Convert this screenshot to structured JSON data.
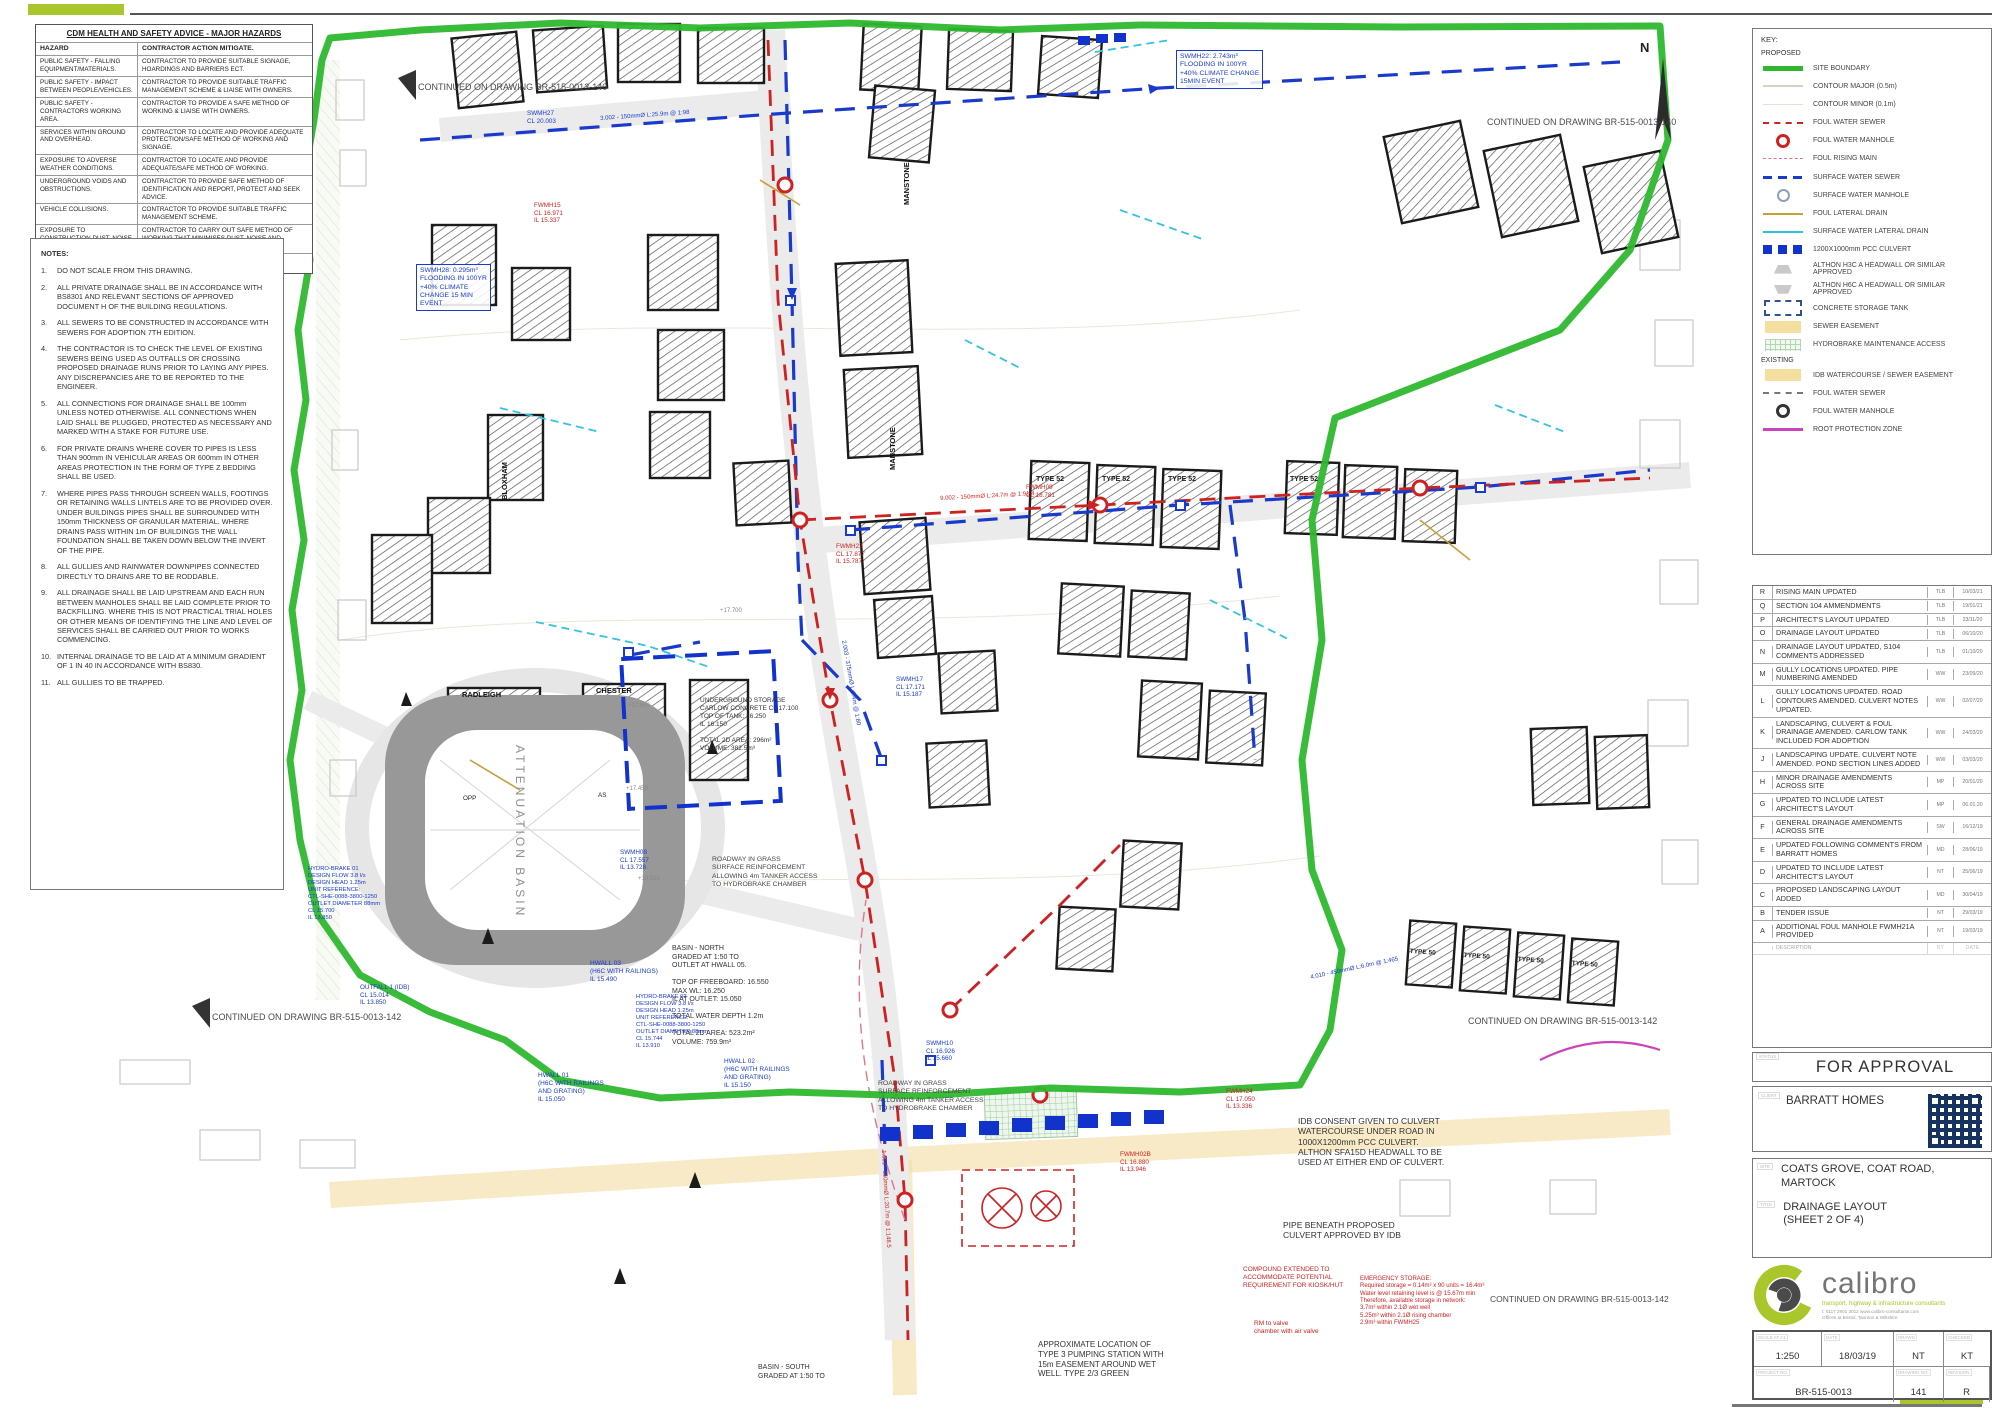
{
  "hazards": {
    "title": "CDM HEALTH AND SAFETY ADVICE - MAJOR HAZARDS",
    "col_hazard": "HAZARD",
    "col_action": "CONTRACTOR ACTION MITIGATE.",
    "rows": [
      {
        "hazard": "PUBLIC SAFETY - FALLING EQUIPMENT/MATERIALS.",
        "action": "CONTRACTOR TO PROVIDE SUITABLE SIGNAGE, HOARDINGS AND BARRIERS ECT."
      },
      {
        "hazard": "PUBLIC SAFETY - IMPACT BETWEEN PEOPLE/VEHICLES.",
        "action": "CONTRACTOR TO PROVIDE SUITABLE TRAFFIC MANAGEMENT SCHEME & LIAISE WITH OWNERS."
      },
      {
        "hazard": "PUBLIC SAFETY - CONTRACTORS WORKING AREA.",
        "action": "CONTRACTOR TO PROVIDE A SAFE METHOD OF WORKING & LIAISE WITH OWNERS."
      },
      {
        "hazard": "SERVICES WITHIN GROUND AND OVERHEAD.",
        "action": "CONTRACTOR TO LOCATE AND PROVIDE ADEQUATE PROTECTION/SAFE METHOD OF WORKING AND SIGNAGE."
      },
      {
        "hazard": "EXPOSURE TO ADVERSE WEATHER CONDITIONS.",
        "action": "CONTRACTOR TO LOCATE AND PROVIDE ADEQUATE/SAFE METHOD OF WORKING."
      },
      {
        "hazard": "UNDERGROUND VOIDS AND OBSTRUCTIONS.",
        "action": "CONTRACTOR TO PROVIDE SAFE METHOD OF IDENTIFICATION AND REPORT, PROTECT AND SEEK ADVICE."
      },
      {
        "hazard": "VEHICLE COLLISIONS.",
        "action": "CONTRACTOR TO PROVIDE SUITABLE TRAFFIC MANAGEMENT SCHEME."
      },
      {
        "hazard": "EXPOSURE TO CONSTRUCTION DUST, NOISE AND VIBRATION.",
        "action": "CONTRACTOR TO CARRY OUT SAFE METHOD OF WORKING THAT MINIMISES DUST, NOISE AND VIBRATION."
      }
    ],
    "footer": "THE HAZARDS IDENTIFIED ABOVE SHOULD NOT BE ASSUMED TO BE THE ONLY HAZARDS THAT COULD BE PRESENT ON THIS SITE."
  },
  "notes": {
    "title": "NOTES:",
    "items": [
      {
        "num": "1.",
        "text": "DO NOT SCALE FROM THIS DRAWING."
      },
      {
        "num": "2.",
        "text": "ALL PRIVATE DRAINAGE SHALL BE IN ACCORDANCE WITH BS8301 AND RELEVANT SECTIONS OF APPROVED DOCUMENT H OF THE BUILDING REGULATIONS."
      },
      {
        "num": "3.",
        "text": "ALL SEWERS TO BE CONSTRUCTED IN ACCORDANCE WITH SEWERS FOR ADOPTION 7TH EDITION."
      },
      {
        "num": "4.",
        "text": "THE CONTRACTOR IS TO CHECK THE LEVEL OF EXISTING SEWERS BEING USED AS OUTFALLS OR CROSSING PROPOSED DRAINAGE RUNS PRIOR TO LAYING ANY PIPES. ANY DISCREPANCIES ARE TO BE REPORTED TO THE ENGINEER."
      },
      {
        "num": "5.",
        "text": "ALL CONNECTIONS FOR DRAINAGE SHALL BE 100mm UNLESS NOTED OTHERWISE. ALL CONNECTIONS WHEN LAID SHALL BE PLUGGED, PROTECTED AS NECESSARY AND MARKED WITH A STAKE FOR FUTURE USE."
      },
      {
        "num": "6.",
        "text": "FOR PRIVATE DRAINS WHERE COVER TO PIPES IS LESS THAN 900mm IN VEHICULAR AREAS OR 600mm IN OTHER AREAS PROTECTION IN THE FORM OF TYPE Z BEDDING SHALL BE USED."
      },
      {
        "num": "7.",
        "text": "WHERE PIPES PASS THROUGH SCREEN WALLS, FOOTINGS OR RETAINING WALLS LINTELS ARE TO BE PROVIDED OVER. UNDER BUILDINGS PIPES SHALL BE SURROUNDED WITH 150mm THICKNESS OF GRANULAR MATERIAL. WHERE DRAINS PASS WITHIN 1m OF BUILDINGS THE WALL FOUNDATION SHALL BE TAKEN DOWN BELOW THE INVERT OF THE PIPE."
      },
      {
        "num": "8.",
        "text": "ALL GULLIES AND RAINWATER DOWNPIPES CONNECTED DIRECTLY TO DRAINS ARE TO BE RODDABLE."
      },
      {
        "num": "9.",
        "text": "ALL DRAINAGE SHALL BE LAID UPSTREAM AND EACH RUN BETWEEN MANHOLES SHALL BE LAID COMPLETE PRIOR TO BACKFILLING. WHERE THIS IS NOT PRACTICAL TRIAL HOLES OR OTHER MEANS OF IDENTIFYING THE LINE AND LEVEL OF SERVICES SHALL BE CARRIED OUT PRIOR TO WORKS COMMENCING."
      },
      {
        "num": "10.",
        "text": "INTERNAL DRAINAGE TO BE LAID AT A MINIMUM GRADIENT OF 1 IN 40 IN ACCORDANCE WITH BS830."
      },
      {
        "num": "11.",
        "text": "ALL GULLIES TO BE TRAPPED."
      }
    ]
  },
  "key": {
    "title": "KEY:",
    "proposed_label": "PROPOSED",
    "existing_label": "EXISTING",
    "proposed": [
      {
        "label": "SITE BOUNDARY",
        "swatch": "sw-boundary"
      },
      {
        "label": "CONTOUR MAJOR (0.5m)",
        "swatch": "sw-contour-major"
      },
      {
        "label": "CONTOUR MINOR (0.1m)",
        "swatch": "sw-contour-minor"
      },
      {
        "label": "FOUL WATER SEWER",
        "swatch": "sw-foul"
      },
      {
        "label": "FOUL WATER MANHOLE",
        "swatch": "sw-foul-mh"
      },
      {
        "label": "FOUL RISING MAIN",
        "swatch": "sw-rising"
      },
      {
        "label": "SURFACE WATER SEWER",
        "swatch": "sw-sw"
      },
      {
        "label": "SURFACE WATER MANHOLE",
        "swatch": "sw-sw-mh"
      },
      {
        "label": "FOUL LATERAL DRAIN",
        "swatch": "sw-foul-lat"
      },
      {
        "label": "SURFACE WATER LATERAL DRAIN",
        "swatch": "sw-sw-lat"
      },
      {
        "label": "1200X1000mm PCC CULVERT",
        "swatch": "sw-culvert"
      },
      {
        "label": "ALTHON H3C A HEADWALL OR SIMILAR APPROVED",
        "swatch": "sw-headwall-a"
      },
      {
        "label": "ALTHON H6C A HEADWALL OR SIMILAR APPROVED",
        "swatch": "sw-headwall-b"
      },
      {
        "label": "CONCRETE STORAGE TANK",
        "swatch": "sw-tank"
      },
      {
        "label": "SEWER EASEMENT",
        "swatch": "sw-easement"
      },
      {
        "label": "HYDROBRAKE MAINTENANCE ACCESS",
        "swatch": "sw-hydro"
      }
    ],
    "existing": [
      {
        "label": "IDB WATERCOURSE / SEWER EASEMENT",
        "swatch": "sw-easement"
      },
      {
        "label": "FOUL WATER SEWER",
        "swatch": "sw-ex-foul"
      },
      {
        "label": "FOUL WATER MANHOLE",
        "swatch": "sw-ex-foul-mh"
      },
      {
        "label": "ROOT PROTECTION ZONE",
        "swatch": "sw-root"
      }
    ]
  },
  "revisions": {
    "rows": [
      {
        "rev": "R",
        "desc": "RISING MAIN UPDATED",
        "by": "TLB",
        "date": "10/03/21"
      },
      {
        "rev": "Q",
        "desc": "SECTION 104 AMMENDMENTS",
        "by": "TLB",
        "date": "19/01/21"
      },
      {
        "rev": "P",
        "desc": "ARCHITECT'S LAYOUT UPDATED",
        "by": "TLB",
        "date": "23/11/20"
      },
      {
        "rev": "O",
        "desc": "DRAINAGE LAYOUT UPDATED",
        "by": "TLB",
        "date": "06/10/20"
      },
      {
        "rev": "N",
        "desc": "DRAINAGE LAYOUT UPDATED, S104 COMMENTS ADDRESSED",
        "by": "TLB",
        "date": "01/10/20"
      },
      {
        "rev": "M",
        "desc": "GULLY LOCATIONS UPDATED. PIPE NUMBERING AMENDED",
        "by": "WW",
        "date": "23/09/20"
      },
      {
        "rev": "L",
        "desc": "GULLY LOCATIONS UPDATED. ROAD CONTOURS AMENDED. CULVERT NOTES UPDATED.",
        "by": "WW",
        "date": "02/07/20"
      },
      {
        "rev": "K",
        "desc": "LANDSCAPING, CULVERT & FOUL DRAINAGE AMENDED. CARLOW TANK INCLUDED FOR ADOPTION",
        "by": "WW",
        "date": "24/03/20"
      },
      {
        "rev": "J",
        "desc": "LANDSCAPING UPDATE. CULVERT NOTE AMENDED. POND SECTION LINES ADDED",
        "by": "WW",
        "date": "03/03/20"
      },
      {
        "rev": "H",
        "desc": "MINOR DRAINAGE AMENDMENTS ACROSS SITE",
        "by": "MP",
        "date": "20/01/20"
      },
      {
        "rev": "G",
        "desc": "UPDATED TO INCLUDE LATEST ARCHITECT'S LAYOUT",
        "by": "MP",
        "date": "06.01.20"
      },
      {
        "rev": "F",
        "desc": "GENERAL DRAINAGE AMENDMENTS ACROSS SITE",
        "by": "SW",
        "date": "16/12/19"
      },
      {
        "rev": "E",
        "desc": "UPDATED FOLLOWING COMMENTS FROM BARRATT HOMES",
        "by": "MD",
        "date": "28/06/19"
      },
      {
        "rev": "D",
        "desc": "UPDATED TO INCLUDE LATEST ARCHITECT'S LAYOUT",
        "by": "NT",
        "date": "25/06/19"
      },
      {
        "rev": "C",
        "desc": "PROPOSED LANDSCAPING LAYOUT ADDED",
        "by": "MD",
        "date": "30/04/19"
      },
      {
        "rev": "B",
        "desc": "TENDER ISSUE",
        "by": "NT",
        "date": "29/03/19"
      },
      {
        "rev": "A",
        "desc": "ADDITIONAL FOUL MANHOLE FWMH21A PROVIDED",
        "by": "NT",
        "date": "19/03/19"
      }
    ],
    "head": {
      "rev": "",
      "desc": "DESCRIPTION",
      "by": "BY",
      "date": "DATE"
    }
  },
  "titleblock": {
    "status_label": "STATUS",
    "status": "FOR APPROVAL",
    "client_label": "CLIENT",
    "client": "BARRATT HOMES",
    "site_label": "SITE",
    "site": "COATS GROVE, COAT ROAD,\nMARTOCK",
    "title_label": "TITLE",
    "drawing_title": "DRAINAGE LAYOUT\n(SHEET 2 OF 4)",
    "logo_word": "calibro",
    "logo_tagline": "transport, highway & infrastructure consultants",
    "logo_contact": "t: 0117 2901 3012        www.calibro-consultants.com\nOffices at Bristol, Taunton & Wiltshire",
    "scale_label": "SCALE AT A1",
    "scale": "1:250",
    "date_label": "DATE",
    "date": "18/03/19",
    "drawn_label": "DRAWN",
    "drawn": "NT",
    "checked_label": "CHECKED",
    "checked": "KT",
    "project_no_label": "PROJECT NO.",
    "project_no": "BR-515-0013",
    "drawing_no_label": "DRAWING NO.",
    "drawing_no": "141",
    "revision_label": "REVISION",
    "revision": "R"
  },
  "plan": {
    "north": "N",
    "annotations": [
      {
        "text": "CONTINUED ON DRAWING BR-515-0013-140",
        "x": 418,
        "y": 82,
        "color": "#4a4a4a",
        "size": 9
      },
      {
        "text": "CONTINUED ON DRAWING BR-515-0013-140",
        "x": 1487,
        "y": 117,
        "color": "#4a4a4a",
        "size": 9
      },
      {
        "text": "CONTINUED ON DRAWING BR-515-0013-142",
        "x": 212,
        "y": 1012,
        "color": "#4a4a4a",
        "size": 9
      },
      {
        "text": "CONTINUED ON DRAWING BR-515-0013-142",
        "x": 1468,
        "y": 1016,
        "color": "#4a4a4a",
        "size": 9
      },
      {
        "text": "CONTINUED ON DRAWING BR-515-0013-142",
        "x": 1490,
        "y": 1294,
        "color": "#4a4a4a",
        "size": 8.5
      },
      {
        "text": "TIMBER KNEE RAIL FENCING AROUND TOP\nOF ATTENUATION BASIN - REFER TO\nARCHITECT'S PLANS FOR DETAILS",
        "x": 80,
        "y": 782,
        "color": "#555555",
        "size": 7.5,
        "w": 175
      },
      {
        "text": "BASIN - NORTH\nGRADED AT 1:50 TO\nOUTLET AT HWALL 05.\n\nTOP OF FREEBOARD: 16.550\nMAX WL: 16.250\nIL AT OUTLET: 15.050\n\nTOTAL WATER DEPTH 1.2m\n\nTOTAL 2D AREA: 523.2m²\nVOLUME: 759.9m³",
        "x": 672,
        "y": 945,
        "color": "#333333",
        "size": 7,
        "w": 130
      },
      {
        "text": "HWALL 03\n(H6C WITH RAILINGS)\nIL 15.490",
        "x": 590,
        "y": 960,
        "color": "#1a3acc",
        "size": 6.5
      },
      {
        "text": "HWALL 01\n(H6C WITH RAILINGS\nAND GRATING)\nIL 15.050",
        "x": 538,
        "y": 1072,
        "color": "#1a3acc",
        "size": 6.5
      },
      {
        "text": "HWALL 02\n(H6C WITH RAILINGS\nAND GRATING)\nIL 15.150",
        "x": 724,
        "y": 1058,
        "color": "#1a3acc",
        "size": 6.5
      },
      {
        "text": "IDB CONSENT GIVEN TO  CULVERT\nWATERCOURSE UNDER ROAD IN\n1000X1200mm PCC CULVERT.\nALTHON SFA15D HEADWALL TO BE\nUSED AT EITHER END OF CULVERT.",
        "x": 1298,
        "y": 1116,
        "color": "#333333",
        "size": 8.5
      },
      {
        "text": "PIPE BENEATH PROPOSED\nCULVERT APPROVED BY IDB",
        "x": 1283,
        "y": 1220,
        "color": "#333333",
        "size": 8.5
      },
      {
        "text": "APPROXIMATE  LOCATION OF\nTYPE 3 PUMPING STATION WITH\n15m EASEMENT AROUND WET\nWELL. TYPE 2/3 GREEN",
        "x": 1038,
        "y": 1340,
        "color": "#333333",
        "size": 8
      },
      {
        "text": "EMERGENCY STORAGE:\nRequired storage = 0.14m³ x 90 units = 16.4m³\nWater level retaining level is @ 15.67m min\nTherefore, available storage in network:\n3.7m³ within 2.1Ø wet well\n5.25m³ within 2.1Ø rising chamber\n2.9m³ within FWMH25",
        "x": 1360,
        "y": 1276,
        "color": "#cc2222",
        "size": 6,
        "w": 165
      },
      {
        "text": "COMPOUND EXTENDED TO\nACCOMMODATE POTENTIAL\nREQUIREMENT FOR KIOSK/HUT",
        "x": 1243,
        "y": 1266,
        "color": "#cc2222",
        "size": 6.5
      },
      {
        "text": "RM to valve\nchamber with air valve",
        "x": 1254,
        "y": 1320,
        "color": "#cc2222",
        "size": 6.5
      },
      {
        "text": "ROADWAY IN GRASS\nSURFACE REINFORCEMENT\nALLOWING 4m TANKER ACCESS\nTO HYDROBRAKE CHAMBER",
        "x": 712,
        "y": 856,
        "color": "#444444",
        "size": 6.8
      },
      {
        "text": "ROADWAY IN GRASS\nSURFACE REINFORCEMENT\nALLOWING 4m TANKER ACCESS\nTO HYDROBRAKE CHAMBER",
        "x": 878,
        "y": 1080,
        "color": "#444444",
        "size": 6.8
      },
      {
        "text": "UNDERGROUND STORAGE\nCARLOW CONCRETE CL 17.100\nTOP OF TANK: 16.250\nIL 16.150\n\nTOTAL 2D AREA: 296m²\nVOLUME: 382.5m³",
        "x": 700,
        "y": 697,
        "color": "#333333",
        "size": 6.5,
        "w": 110
      },
      {
        "text": "SWMH28: 0.295m³\nFLOODING IN 100YR\n+40% CLIMATE\nCHANGE 15 MIN\nEVENT",
        "x": 416,
        "y": 264,
        "color": "#1a3acc",
        "size": 6.8,
        "box": true
      },
      {
        "text": "SWMH22: 2.743m³\nFLOODING IN 100YR\n+40% CLIMATE CHANGE\n15MIN EVENT",
        "x": 1176,
        "y": 50,
        "color": "#1a3acc",
        "size": 6.8,
        "box": true
      },
      {
        "text": "SWMH27\nCL 20.003",
        "x": 527,
        "y": 110,
        "color": "#1a3acc",
        "size": 6.3
      },
      {
        "text": "FWMH15\nCL 16.971\nIL 15.337",
        "x": 534,
        "y": 202,
        "color": "#cc2222",
        "size": 6.3
      },
      {
        "text": "SWMH08\nCL 17.557\nIL 13.728",
        "x": 620,
        "y": 849,
        "color": "#1a3acc",
        "size": 6.3
      },
      {
        "text": "OUTFALL 1 (IDB)\nCL 15.014\nIL 13.850",
        "x": 360,
        "y": 984,
        "color": "#1a3acc",
        "size": 6.3
      },
      {
        "text": "HYDRO-BRAKE 01\nDESIGN FLOW 3.8 l/s\nDESIGN HEAD 1.25m\nUNIT REFERENCE:\nCTL-SHE-0088-3800-1250\nOUTLET DIAMETER 88mm\nCL 15.700\nIL 13.850",
        "x": 308,
        "y": 866,
        "color": "#1a3acc",
        "size": 5.8
      },
      {
        "text": "HYDRO-BRAKE 02\nDESIGN FLOW 3.8 l/s\nDESIGN HEAD 1.25m\nUNIT REFERENCE:\nCTL-SHE-0088-3800-1250\nOUTLET DIAMETER 88mm\nCL 15.744\nIL 13.910",
        "x": 636,
        "y": 994,
        "color": "#1a3acc",
        "size": 5.8
      },
      {
        "text": "BASIN - SOUTH\nGRADED AT 1:50 TO",
        "x": 758,
        "y": 1364,
        "color": "#333333",
        "size": 7
      },
      {
        "text": "SWMH10\nCL 16.926\nIL 15.660",
        "x": 926,
        "y": 1040,
        "color": "#1a3acc",
        "size": 6.3
      },
      {
        "text": "FWMH02B\nCL 16.880\nIL 13.946",
        "x": 1120,
        "y": 1151,
        "color": "#cc2222",
        "size": 6.3
      },
      {
        "text": "FWMH24\nCL 17.050\nIL 13.336",
        "x": 1226,
        "y": 1088,
        "color": "#cc2222",
        "size": 6.3
      },
      {
        "text": "FWMH09\nCL 18.781",
        "x": 1026,
        "y": 484,
        "color": "#cc2222",
        "size": 6.3
      },
      {
        "text": "SWMH17\nCL 17.171\nIL 15.187",
        "x": 896,
        "y": 676,
        "color": "#1a3acc",
        "size": 6.3
      },
      {
        "text": "FWMH22\nCL 17.877\nIL 15.787",
        "x": 836,
        "y": 543,
        "color": "#cc2222",
        "size": 6.3
      },
      {
        "text": "TYPE 52",
        "x": 1036,
        "y": 476,
        "color": "#1b1b1b",
        "size": 7,
        "bold": true
      },
      {
        "text": "TYPE 52",
        "x": 1102,
        "y": 476,
        "color": "#1b1b1b",
        "size": 7,
        "bold": true
      },
      {
        "text": "TYPE 52",
        "x": 1168,
        "y": 476,
        "color": "#1b1b1b",
        "size": 7,
        "bold": true
      },
      {
        "text": "TYPE 52",
        "x": 1290,
        "y": 476,
        "color": "#1b1b1b",
        "size": 7,
        "bold": true
      },
      {
        "text": "TYPE 50",
        "x": 1410,
        "y": 948,
        "color": "#1b1b1b",
        "size": 6.5,
        "bold": true,
        "rot": 4
      },
      {
        "text": "TYPE 50",
        "x": 1464,
        "y": 952,
        "color": "#1b1b1b",
        "size": 6.5,
        "bold": true,
        "rot": 4
      },
      {
        "text": "TYPE 50",
        "x": 1518,
        "y": 956,
        "color": "#1b1b1b",
        "size": 6.5,
        "bold": true,
        "rot": 4
      },
      {
        "text": "TYPE 50",
        "x": 1572,
        "y": 960,
        "color": "#1b1b1b",
        "size": 6.5,
        "bold": true,
        "rot": 4
      },
      {
        "text": "RADLEIGH",
        "x": 462,
        "y": 690,
        "color": "#111111",
        "size": 7.5,
        "bold": true
      },
      {
        "text": "CHESTER",
        "x": 596,
        "y": 686,
        "color": "#111111",
        "size": 7.5,
        "bold": true
      },
      {
        "text": "BLOXHAM",
        "x": 500,
        "y": 500,
        "color": "#111111",
        "size": 7.5,
        "bold": true,
        "rot": -90
      },
      {
        "text": "MANSTONE",
        "x": 888,
        "y": 470,
        "color": "#111111",
        "size": 7.5,
        "bold": true,
        "rot": -90
      },
      {
        "text": "MANSTONE",
        "x": 902,
        "y": 205,
        "color": "#111111",
        "size": 7.5,
        "bold": true,
        "rot": -90
      },
      {
        "text": "OPP",
        "x": 463,
        "y": 795,
        "color": "#1b1b1b",
        "size": 6.3
      },
      {
        "text": "AS",
        "x": 598,
        "y": 792,
        "color": "#1b1b1b",
        "size": 6.3
      },
      {
        "text": "ATTENUATION BASIN",
        "x": 527,
        "y": 745,
        "color": "#8f8f8f",
        "size": 12,
        "rot": 90,
        "ls": 3
      },
      {
        "text": "+17.700",
        "x": 720,
        "y": 608,
        "color": "#888888",
        "size": 6
      },
      {
        "text": "+17.650",
        "x": 628,
        "y": 703,
        "color": "#888888",
        "size": 6
      },
      {
        "text": "+17.450",
        "x": 626,
        "y": 786,
        "color": "#888888",
        "size": 6
      },
      {
        "text": "+18.526",
        "x": 638,
        "y": 876,
        "color": "#888888",
        "size": 6
      },
      {
        "text": "3.002 - 150mmØ L:25.9m @ 1:98",
        "x": 600,
        "y": 116,
        "color": "#1a3acc",
        "size": 6,
        "rot": -4
      },
      {
        "text": "9.002 - 150mmØ L:24.7m @ 1:91.4",
        "x": 940,
        "y": 496,
        "color": "#cc2222",
        "size": 6,
        "rot": -3
      },
      {
        "text": "1.001 - 150mmØ L:20.7m @ 1:148.5",
        "x": 886,
        "y": 1150,
        "color": "#cc2222",
        "size": 6,
        "rot": 87
      },
      {
        "text": "2.003 - 375mmØ L:9.4m @ 1:80",
        "x": 846,
        "y": 640,
        "color": "#1a3acc",
        "size": 6,
        "rot": 80
      },
      {
        "text": "4.010 - 450mmØ L:6.0m @ 1:465",
        "x": 1310,
        "y": 975,
        "color": "#1a3acc",
        "size": 6,
        "rot": -12
      }
    ]
  }
}
